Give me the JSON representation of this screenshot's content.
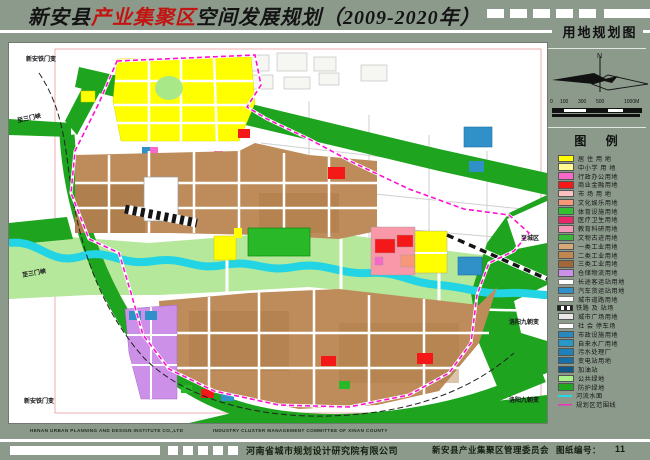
{
  "title": {
    "prefix": "新安县",
    "highlight": "产业集聚区",
    "suffix": "空间发展规划（2009-2020年）"
  },
  "sheet": {
    "map_title": "用地规划图",
    "legend_title": "图 例",
    "north_label": "N",
    "scale_labels": [
      "0",
      "100",
      "300",
      "500",
      "1000M"
    ]
  },
  "colors": {
    "background": "#8C9A8C",
    "title_red": "#C21410",
    "boundary_magenta": "#FF10D0",
    "river_cyan": "#22D4E4"
  },
  "legend": {
    "items": [
      {
        "label": "居 住 用 地",
        "swatch": "fill",
        "color": "#FFFF00"
      },
      {
        "label": "中小学 用 地",
        "swatch": "fill",
        "color": "#FFF990"
      },
      {
        "label": "行政办公用地",
        "swatch": "fill",
        "color": "#F868C8"
      },
      {
        "label": "商业金融用地",
        "swatch": "fill",
        "color": "#F41818"
      },
      {
        "label": "市 场 用 地",
        "swatch": "fill",
        "color": "#FBC0C0"
      },
      {
        "label": "文化娱乐用地",
        "swatch": "fill",
        "color": "#F89878"
      },
      {
        "label": "体育设施用地",
        "swatch": "fill",
        "color": "#30C030"
      },
      {
        "label": "医疗卫生用地",
        "swatch": "fill",
        "color": "#E82868"
      },
      {
        "label": "教育科研用地",
        "swatch": "fill",
        "color": "#F898B8"
      },
      {
        "label": "文物古迹用地",
        "swatch": "fill",
        "color": "#38B838"
      },
      {
        "label": "一类工业用地",
        "swatch": "fill",
        "color": "#D8A878"
      },
      {
        "label": "二类工业用地",
        "swatch": "fill",
        "color": "#C08850"
      },
      {
        "label": "三类工业用地",
        "swatch": "fill",
        "color": "#A06838"
      },
      {
        "label": "仓储物流用地",
        "swatch": "fill",
        "color": "#CC90E8"
      },
      {
        "label": "长途客运站用地",
        "swatch": "road",
        "color": "#F8F8F8"
      },
      {
        "label": "汽车货运站用地",
        "swatch": "fill",
        "color": "#3090C8"
      },
      {
        "label": "城市道路用地",
        "swatch": "road",
        "color": "#FFFFFF"
      },
      {
        "label": "铁路 及 站场",
        "swatch": "railway",
        "color": "#303030"
      },
      {
        "label": "城市广场用地",
        "swatch": "fill",
        "color": "#E8E8E8"
      },
      {
        "label": "社 会 停车场",
        "swatch": "road",
        "color": "#F0F0F0"
      },
      {
        "label": "市政设施用地",
        "swatch": "fill",
        "color": "#2888C0"
      },
      {
        "label": "自来水厂用地",
        "swatch": "fill",
        "color": "#2898C8"
      },
      {
        "label": "污水处理厂",
        "swatch": "fill",
        "color": "#2080B8"
      },
      {
        "label": "变电站用地",
        "swatch": "fill",
        "color": "#1870A8"
      },
      {
        "label": "加油站",
        "swatch": "fill",
        "color": "#105888"
      },
      {
        "label": "公共绿地",
        "swatch": "fill",
        "color": "#A8F088"
      },
      {
        "label": "防护绿地",
        "swatch": "fill",
        "color": "#20A820"
      },
      {
        "label": "河流水面",
        "swatch": "line",
        "color": "#28D8E8"
      },
      {
        "label": "规划区范围线",
        "swatch": "line",
        "color": "#F030C0"
      }
    ]
  },
  "map": {
    "labels": [
      {
        "text": "新安铁门变",
        "x": 17,
        "y": 11,
        "rot": 0
      },
      {
        "text": "至三门峡",
        "x": 8,
        "y": 70,
        "rot": -12
      },
      {
        "text": "至三门峡",
        "x": 13,
        "y": 225,
        "rot": -10
      },
      {
        "text": "新安铁门变",
        "x": 15,
        "y": 353,
        "rot": 0
      },
      {
        "text": "至城区",
        "x": 512,
        "y": 190,
        "rot": 0
      },
      {
        "text": "洛阳九朝变",
        "x": 500,
        "y": 274,
        "rot": 0
      },
      {
        "text": "洛阳九朝变",
        "x": 500,
        "y": 352,
        "rot": 0
      }
    ]
  },
  "footer": {
    "english_left": "HENAN URBAN PLANNING AND DESIGN INSTITUTE CO.,LTD",
    "english_right": "INDUSTRY CLUSTER MANAGEMENT COMMITTEE OF XINAN COUNTY",
    "company_left": "河南省城市规划设计研究院有限公司",
    "company_right": "新安县产业集聚区管理委员会",
    "sheet_label": "图纸编号：",
    "sheet_number": "11"
  }
}
